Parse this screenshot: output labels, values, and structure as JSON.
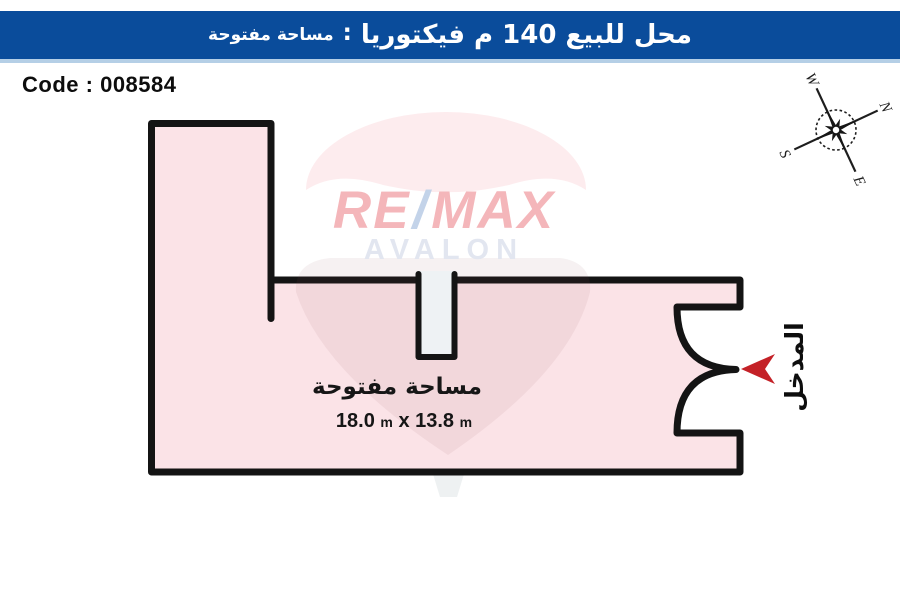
{
  "header": {
    "title_main": "محل للبيع  140 م  فيكتوريا",
    "separator": ":",
    "title_sub": "مساحة مفتوحة",
    "bar_color": "#0a4c9b",
    "underline_color": "#b5cfe6"
  },
  "code_panel": {
    "label": "Code",
    "separator": ":",
    "value": "008584"
  },
  "floor_plan": {
    "area_label": "مساحة مفتوحة",
    "dimensions": {
      "width_m": "18.0",
      "unit": "m",
      "separator": "x",
      "depth_m": "13.8"
    },
    "entrance_label": "المدخل",
    "room_fill": "#fbe3e7",
    "wall_color": "#141414",
    "arrow_color": "#c42127",
    "column_fill": "#eef2f4"
  },
  "compass": {
    "n": "N",
    "e": "E",
    "s": "S",
    "w": "W"
  },
  "watermark": {
    "re": "RE",
    "slash": "/",
    "max": "MAX",
    "sub_brand": "AVALON"
  }
}
